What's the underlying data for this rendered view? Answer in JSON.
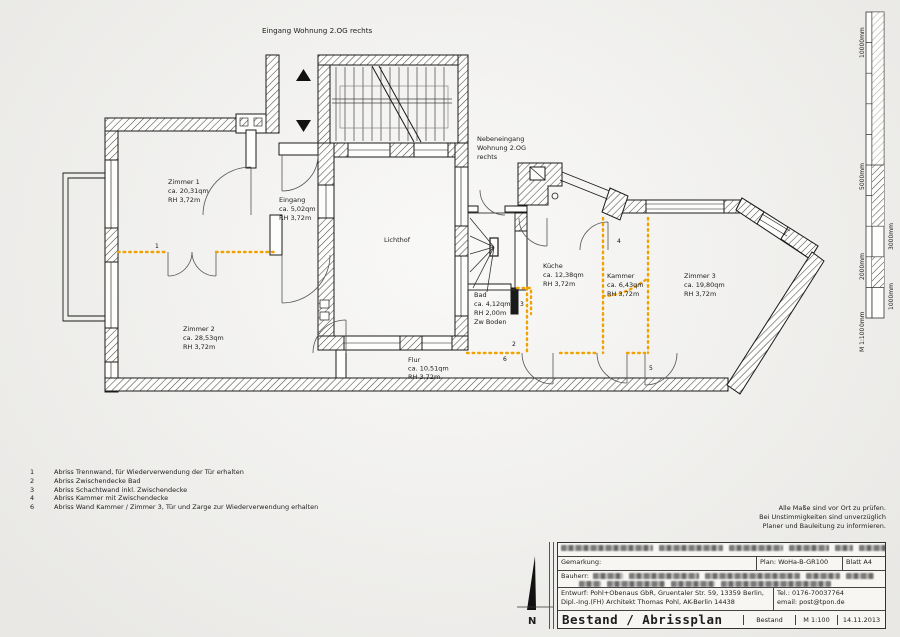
{
  "colors": {
    "paper": "#f2f1ee",
    "line": "#1a1a1a",
    "demolition_orange": "#f0a300"
  },
  "plan": {
    "top_label": "Eingang Wohnung 2.OG rechts",
    "side_label": {
      "l1": "Nebeneingang",
      "l2": "Wohnung 2.OG",
      "l3": "rechts"
    },
    "north_label": "N",
    "rooms": [
      {
        "name": "Zimmer 1",
        "area": "ca. 20,31qm",
        "rh": "RH 3,72m"
      },
      {
        "name": "Eingang",
        "area": "ca. 5,02qm",
        "rh": "RH 3,72m"
      },
      {
        "name": "Zimmer 2",
        "area": "ca. 28,53qm",
        "rh": "RH 3,72m"
      },
      {
        "name": "Lichthof"
      },
      {
        "name": "Bad",
        "area": "ca. 4,12qm",
        "rh": "RH 2,00m",
        "extra": "Zw Boden"
      },
      {
        "name": "Küche",
        "area": "ca. 12,38qm",
        "rh": "RH 3,72m"
      },
      {
        "name": "Kammer",
        "area": "ca. 6,43qm",
        "rh": "RH 3,72m"
      },
      {
        "name": "Zimmer 3",
        "area": "ca. 19,80qm",
        "rh": "RH 3,72m"
      },
      {
        "name": "Flur",
        "area": "ca. 10,51qm",
        "rh": "RH 3,72m"
      }
    ],
    "markers": [
      "1",
      "2",
      "3",
      "4",
      "5",
      "6"
    ]
  },
  "legend": {
    "items": [
      {
        "num": "1",
        "text": "Abriss Trennwand, für Wiederverwendung der Tür erhalten"
      },
      {
        "num": "2",
        "text": "Abriss Zwischendecke Bad"
      },
      {
        "num": "3",
        "text": "Abriss Schachtwand inkl. Zwischendecke"
      },
      {
        "num": "4",
        "text": "Abriss Kammer mit Zwischendecke"
      },
      {
        "num": "6",
        "text": "Abriss Wand Kammer / Zimmer 3, Tür und Zarge zur Wiederverwendung erhalten"
      }
    ]
  },
  "notes": [
    "Alle Maße sind vor Ort zu prüfen.",
    "Bei Unstimmigkeiten sind unverzüglich",
    "Planer und Bauleitung zu informieren."
  ],
  "scalebar": {
    "labels": [
      "10000mm",
      "5000mm",
      "3000mm",
      "2000mm",
      "1000mm",
      "0mm"
    ],
    "scale": "M 1:100"
  },
  "titleblock": {
    "gemarkung_label": "Gemarkung:",
    "plan_no": "Plan: WoHa-B-GR100",
    "sheet": "Blatt A4",
    "bauherr_label": "Bauherr:",
    "entwurf_line1": "Entwurf: Pohl+Obenaus GbR, Gruentaler Str. 59, 13359 Berlin,",
    "entwurf_line2": "Dipl.-Ing.(FH) Architekt Thomas Pohl, AK-Berlin 14438",
    "tel": "Tel.: 0176-70037764",
    "email": "email: post@tpon.de",
    "title": "Bestand / Abrissplan",
    "status": "Bestand",
    "scale": "M 1:100",
    "date": "14.11.2013"
  }
}
